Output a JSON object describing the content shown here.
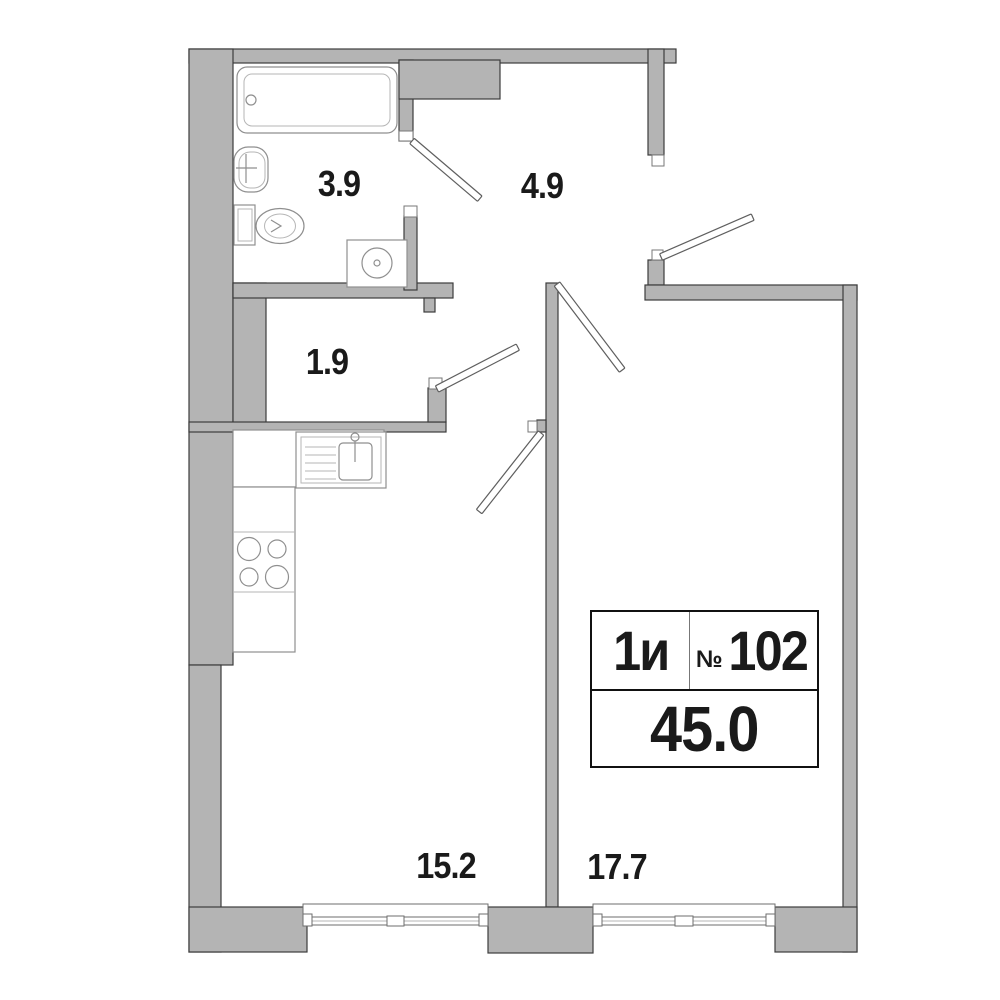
{
  "unit_card": {
    "type_label": "1и",
    "numero_sign": "№",
    "unit_number": "102",
    "total_area": "45.0"
  },
  "room_areas": {
    "bathroom": "3.9",
    "hallway": "4.9",
    "storage": "1.9",
    "kitchen_living": "15.2",
    "bedroom": "17.7"
  },
  "colors": {
    "background": "#ffffff",
    "wall_fill": "#b4b4b4",
    "wall_stroke": "#3c3c3c",
    "fixture_stroke": "#8f8f8f",
    "fixture_light": "#b6b6b6",
    "door_stroke": "#5f5f5f",
    "window_stroke": "#6e6e6e",
    "jamb_stroke": "#777777",
    "text": "#1a1a1a",
    "card_border": "#111111"
  }
}
